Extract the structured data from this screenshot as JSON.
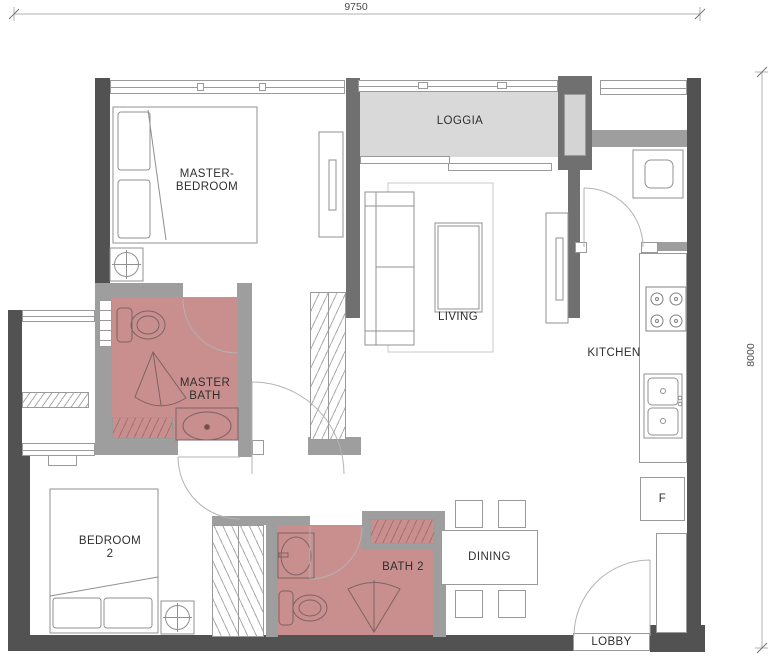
{
  "dimensions": {
    "top": "9750",
    "right": "8000"
  },
  "rooms": {
    "master_bedroom": {
      "line1": "MASTER-",
      "line2": "BEDROOM"
    },
    "loggia": {
      "label": "LOGGIA"
    },
    "living": {
      "label": "LIVING"
    },
    "kitchen": {
      "label": "KITCHEN"
    },
    "master_bath": {
      "line1": "MASTER",
      "line2": "BATH"
    },
    "bedroom2": {
      "line1": "BEDROOM",
      "line2": "2"
    },
    "bath2": {
      "label": "BATH 2"
    },
    "dining": {
      "label": "DINING"
    },
    "lobby": {
      "label": "LOBBY"
    }
  },
  "appliances": {
    "fridge": "F"
  },
  "icons": [
    "bed-icon",
    "pillow-icon",
    "toilet-icon",
    "shower-screen-icon",
    "basin-icon",
    "double-sink-icon",
    "stove-icon",
    "washing-machine-icon",
    "sofa-icon",
    "coffee-table-icon",
    "tv-console-icon",
    "dining-table-icon",
    "chair-icon",
    "ceiling-fan-icon",
    "door-swing-icon",
    "wardrobe-icon"
  ],
  "colors": {
    "wall_dark": "#525252",
    "wall_mid": "#707070",
    "wall_light": "#9e9e9e",
    "bath_fill": "#c98f8f",
    "loggia_fill": "#d9d9d9",
    "line_gray": "#9a9a9a"
  }
}
